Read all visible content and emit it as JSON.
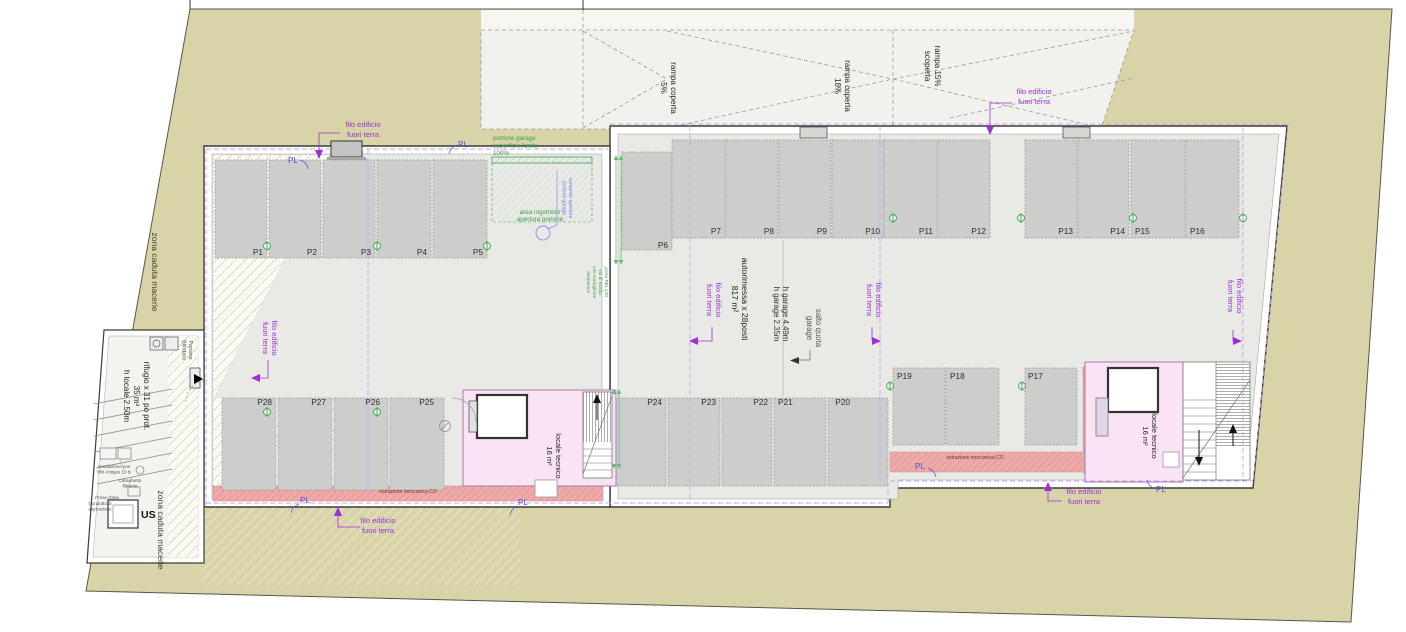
{
  "plan": {
    "type": "garage floor plan",
    "annotations": {
      "ramp1": "rampa coperta\n5%",
      "ramp2": "rampa coperta\n18%",
      "ramp3": "rampa 15%\nscoperta",
      "filo": "filo edificio\nfuori terra",
      "pl": "PL",
      "zona": "zona caduta macerie",
      "autorimessa": "autorimessa x 28posti\n817 m²",
      "h_garage": "h garage 4.49m\nh garage 2.35m",
      "salto": "salto quota\ngarage",
      "rifugio": "rifugio x 31 po prot.\n35 m²\nh locale 2.50m",
      "locale_tecnico": "locale tecnico\n16 m²",
      "estrazione": "estrazione meccanica CO",
      "portone_garage": "portone garage\nsuperficie forata\n100%",
      "area_ingombro": "area ingombro\napertura portone",
      "portone_blindato": "Portone\nBlindato",
      "comando": "comando apertura\nportone garage",
      "nota_verde": "porta REI 120\nvia di esodo\ncon maniglione\nantipanico",
      "us": "US",
      "ventilazione": "Ventilazione con\nfiltri Antigas 19 B",
      "cassonetto": "Cassonetto\nfiltrante",
      "prese": "Prese d'aria",
      "condotto": "Condotto di\naspirazione"
    },
    "stalls": {
      "left_top": [
        "P1",
        "P2",
        "P3",
        "P4",
        "P5"
      ],
      "p6": "P6",
      "right_top": [
        "P7",
        "P8",
        "P9",
        "P10",
        "P11",
        "P12",
        "P13",
        "P14",
        "P15",
        "P16"
      ],
      "right_mid": [
        "P19",
        "P18",
        "P17"
      ],
      "mid_bottom": [
        "P24",
        "P23",
        "P22",
        "P21",
        "P20"
      ],
      "left_bottom": [
        "P28",
        "P27",
        "P26",
        "P25"
      ]
    },
    "colors": {
      "site": "#d8d4a8",
      "floor": "#e9e9e6",
      "stall": "#cdcdcb",
      "pink_room": "#fbe3f6",
      "red_duct": "#edaaa8",
      "purple_note": "#9a30d8",
      "pl_blue": "#5050e0",
      "green_note": "#3aa052",
      "dashed_outline": "#c9a2ef"
    }
  }
}
